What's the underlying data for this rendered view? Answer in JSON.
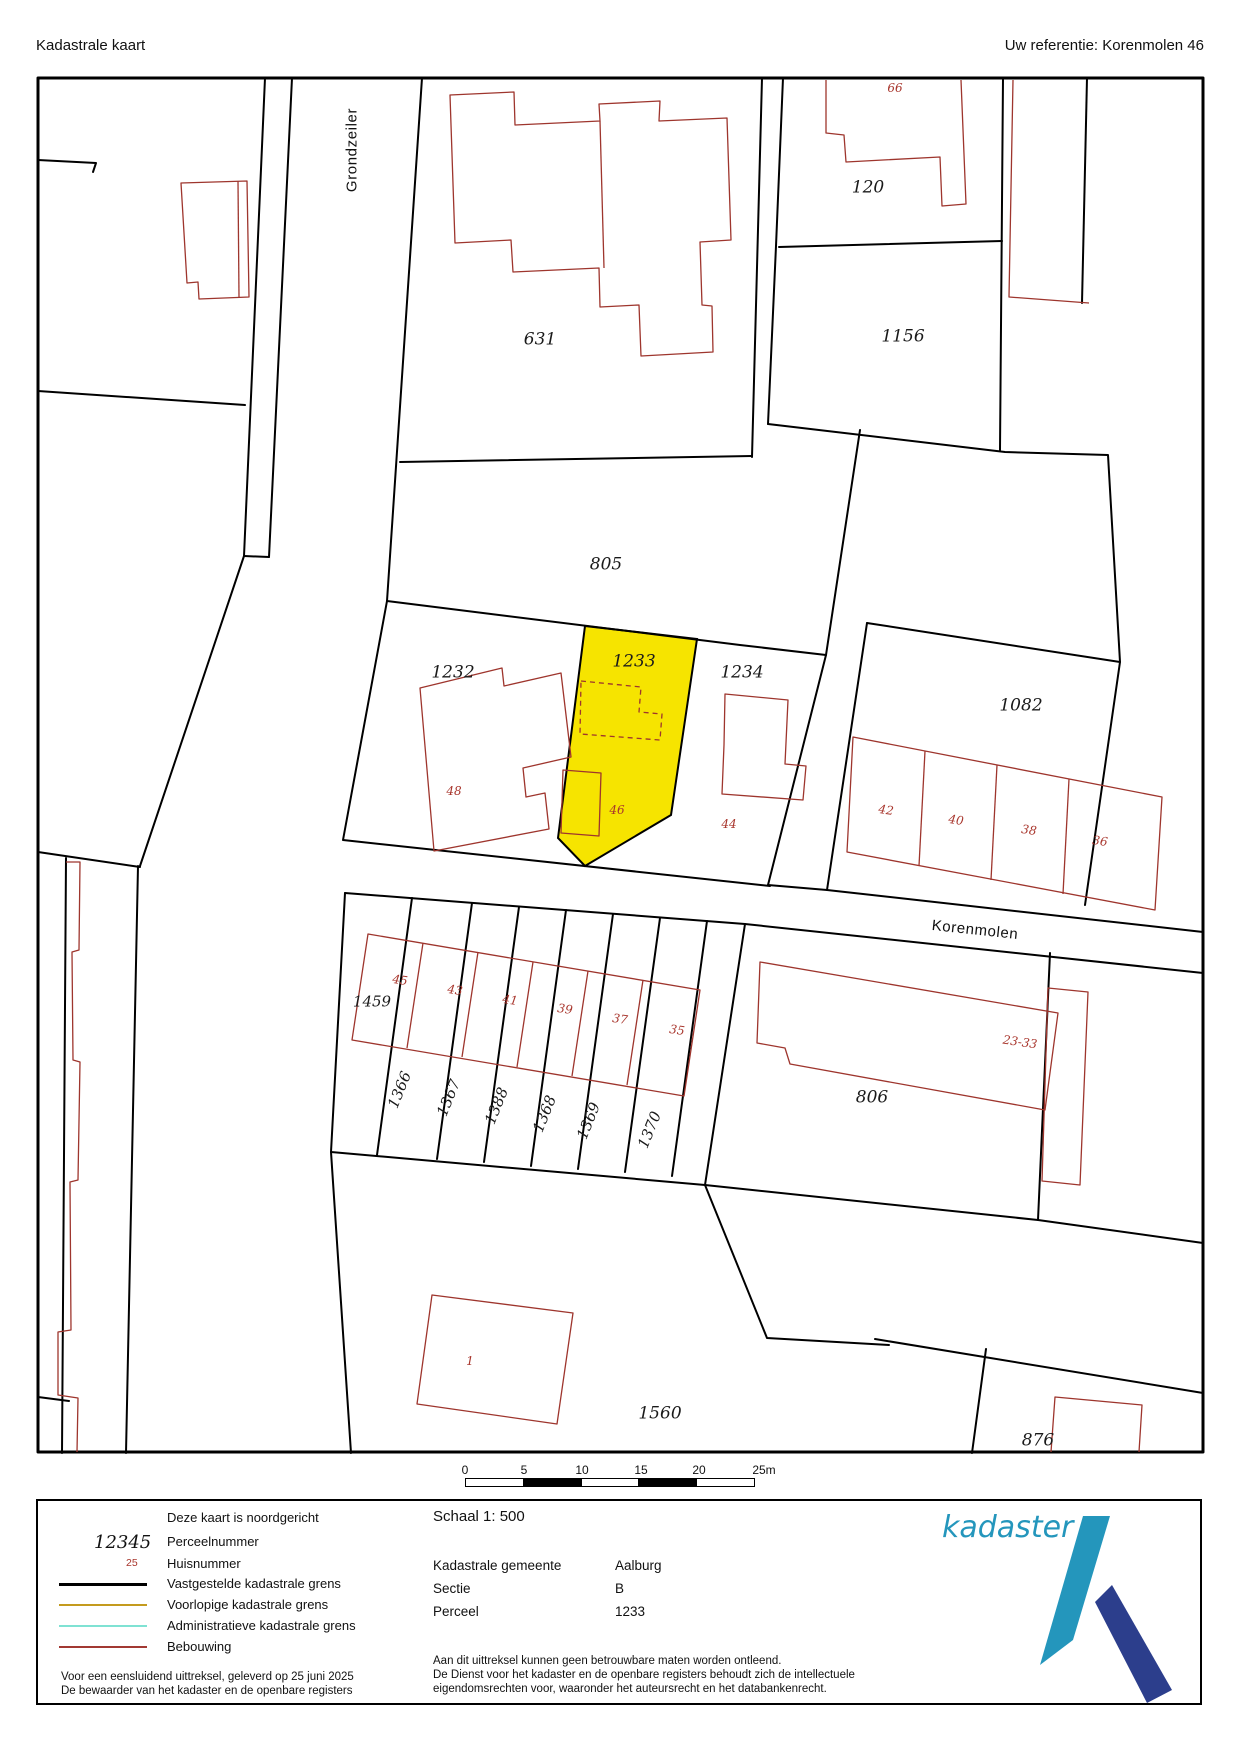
{
  "header": {
    "title": "Kadastrale kaart",
    "reference": "Uw referentie: Korenmolen 46"
  },
  "map": {
    "streets": [
      {
        "label": "Grondzeiler"
      },
      {
        "label": "Korenmolen"
      }
    ],
    "parcels": [
      {
        "label": "631"
      },
      {
        "label": "120"
      },
      {
        "label": "1156"
      },
      {
        "label": "805"
      },
      {
        "label": "1232"
      },
      {
        "label": "1233"
      },
      {
        "label": "1234"
      },
      {
        "label": "1082"
      },
      {
        "label": "1459"
      },
      {
        "label": "1366"
      },
      {
        "label": "1367"
      },
      {
        "label": "1388"
      },
      {
        "label": "1368"
      },
      {
        "label": "1369"
      },
      {
        "label": "1370"
      },
      {
        "label": "806"
      },
      {
        "label": "1560"
      },
      {
        "label": "876"
      }
    ],
    "highlighted_parcel": "1233",
    "highlight_color": "#f6e400",
    "houses": [
      {
        "label": "66"
      },
      {
        "label": "48"
      },
      {
        "label": "46"
      },
      {
        "label": "44"
      },
      {
        "label": "42"
      },
      {
        "label": "40"
      },
      {
        "label": "38"
      },
      {
        "label": "36"
      },
      {
        "label": "45"
      },
      {
        "label": "43"
      },
      {
        "label": "41"
      },
      {
        "label": "39"
      },
      {
        "label": "37"
      },
      {
        "label": "35"
      },
      {
        "label": "23-33"
      },
      {
        "label": "1"
      }
    ]
  },
  "scale_bar": {
    "ticks": [
      "0",
      "5",
      "10",
      "15",
      "20",
      "25m"
    ]
  },
  "legend": {
    "north_note": "Deze kaart is noordgericht",
    "perceel_sample": "12345",
    "perceel_label": "Perceelnummer",
    "huis_sample": "25",
    "huis_label": "Huisnummer",
    "lines": [
      {
        "label": "Vastgestelde kadastrale grens",
        "color": "#000000"
      },
      {
        "label": "Voorlopige kadastrale grens",
        "color": "#c49b1e"
      },
      {
        "label": "Administratieve kadastrale grens",
        "color": "#7fe2d3"
      },
      {
        "label": "Bebouwing",
        "color": "#a23933"
      }
    ],
    "footer_line1": "Voor een eensluidend uittreksel, geleverd op 25 juni 2025",
    "footer_line2": "De bewaarder van het kadaster en de openbare registers"
  },
  "info": {
    "scale_label": "Schaal 1: 500",
    "rows": [
      {
        "label": "Kadastrale gemeente",
        "value": "Aalburg"
      },
      {
        "label": "Sectie",
        "value": "B"
      },
      {
        "label": "Perceel",
        "value": "1233"
      }
    ],
    "disclaimer": [
      "Aan dit uittreksel kunnen geen betrouwbare maten worden ontleend.",
      "De Dienst voor het kadaster en de openbare registers behoudt zich de intellectuele",
      "eigendomsrechten voor, waaronder het auteursrecht en het databankenrecht."
    ]
  },
  "logo": {
    "text": "kadaster",
    "light_blue": "#2496bc",
    "dark_blue": "#2c3e8c"
  }
}
